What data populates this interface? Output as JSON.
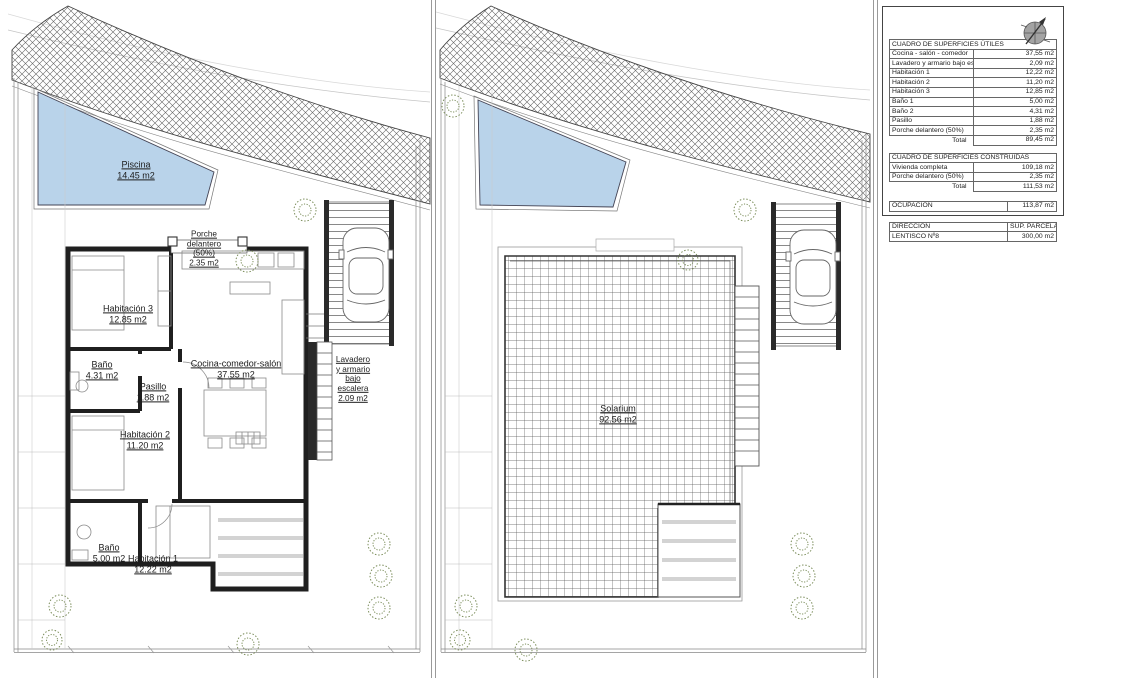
{
  "colors": {
    "pool": "#b9d3ea",
    "wall": "#1f1f1f",
    "plant": "#7d8f5d"
  },
  "ground_plan": {
    "pool": {
      "name": "Piscina",
      "area": "14.45 m2"
    },
    "porch": {
      "lines": [
        "Porche",
        "delantero",
        "(50%)",
        "2.35 m2"
      ]
    },
    "laundry": {
      "lines": [
        "Lavadero",
        "y armario",
        "bajo",
        "escalera",
        "2.09 m2"
      ]
    },
    "rooms": {
      "hab3": {
        "name": "Habitación 3",
        "area": "12.85 m2"
      },
      "banyo2": {
        "name": "Baño",
        "area": "4.31 m2"
      },
      "pasillo": {
        "name": "Pasillo",
        "area": "1.88 m2"
      },
      "salon": {
        "name": "Cocina-comedor-salón",
        "area": "37.55 m2"
      },
      "hab2": {
        "name": "Habitación 2",
        "area": "11.20 m2"
      },
      "banyo1": {
        "name": "Baño",
        "area": "5.00 m2"
      },
      "hab1": {
        "name": "Habitación 1",
        "area": "12.22 m2"
      }
    }
  },
  "roof_plan": {
    "solarium": {
      "name": "Solarium",
      "area": "92.56 m2"
    }
  },
  "summary": {
    "utiles": {
      "title": "CUADRO DE SUPERFICIES ÚTILES",
      "rows": [
        [
          "Cocina - salón - comedor",
          "37,55 m2"
        ],
        [
          "Lavadero y armario bajo escalera",
          "2,09 m2"
        ],
        [
          "Habitación 1",
          "12,22 m2"
        ],
        [
          "Habitación 2",
          "11,20 m2"
        ],
        [
          "Habitación 3",
          "12,85 m2"
        ],
        [
          "Baño 1",
          "5,00 m2"
        ],
        [
          "Baño 2",
          "4,31 m2"
        ],
        [
          "Pasillo",
          "1,88 m2"
        ],
        [
          "Porche delantero (50%)",
          "2,35 m2"
        ]
      ],
      "total_label": "Total",
      "total_value": "89,45 m2"
    },
    "construidas": {
      "title": "CUADRO DE SUPERFICIES CONSTRUIDAS",
      "rows": [
        [
          "Vivienda completa",
          "109,18 m2"
        ],
        [
          "Porche delantero (50%)",
          "2,35 m2"
        ]
      ],
      "total_label": "Total",
      "total_value": "111,53 m2"
    },
    "ocupacion": {
      "label": "OCUPACIÓN",
      "value": "113,87 m2"
    },
    "parcela": {
      "col1": "DIRECCIÓN",
      "col2": "SUP. PARCELA",
      "row1": "LENTISCO Nº8",
      "row2": "300,00 m2"
    }
  }
}
